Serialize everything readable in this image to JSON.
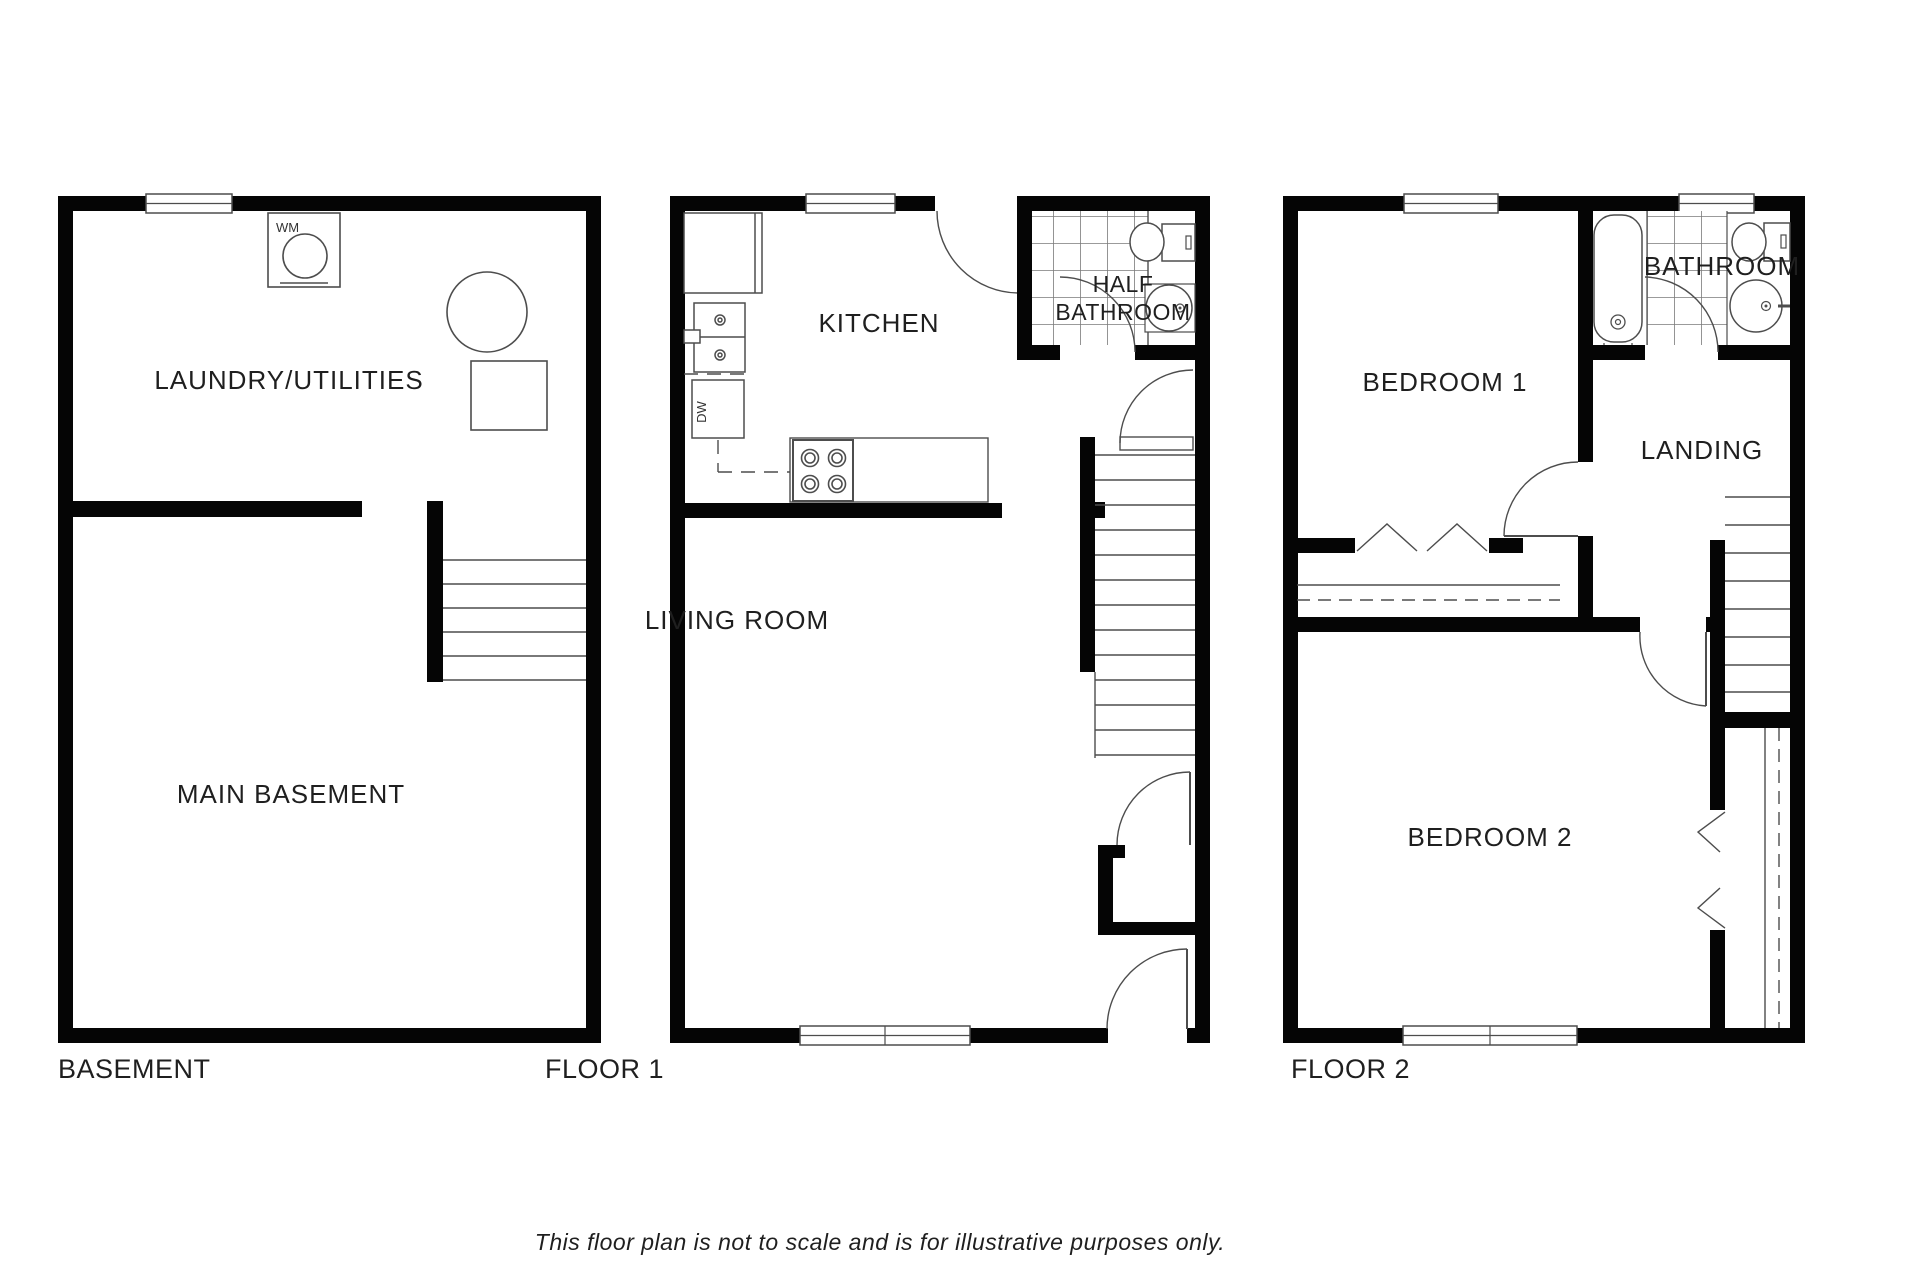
{
  "disclaimer": {
    "text": "This floor plan is not to scale and is for illustrative purposes only.",
    "color": "#9aa0a4"
  },
  "colors": {
    "wall": "#050505",
    "fixture_line": "#4d4d4d",
    "tile_line": "#7a7a7a",
    "label_text": "#1f1f1f"
  },
  "plans": {
    "basement": {
      "title": "BASEMENT",
      "rooms": {
        "laundry": "LAUNDRY/UTILITIES",
        "main": "MAIN BASEMENT"
      },
      "appliances": {
        "washing_machine": "WM"
      }
    },
    "floor1": {
      "title": "FLOOR 1",
      "rooms": {
        "kitchen": "KITCHEN",
        "half_bath_line1": "HALF",
        "half_bath_line2": "BATHROOM",
        "living": "LIVING ROOM"
      },
      "appliances": {
        "dishwasher": "DW"
      }
    },
    "floor2": {
      "title": "FLOOR 2",
      "rooms": {
        "bedroom1": "BEDROOM 1",
        "bathroom": "BATHROOM",
        "landing": "LANDING",
        "bedroom2": "BEDROOM 2"
      }
    }
  }
}
